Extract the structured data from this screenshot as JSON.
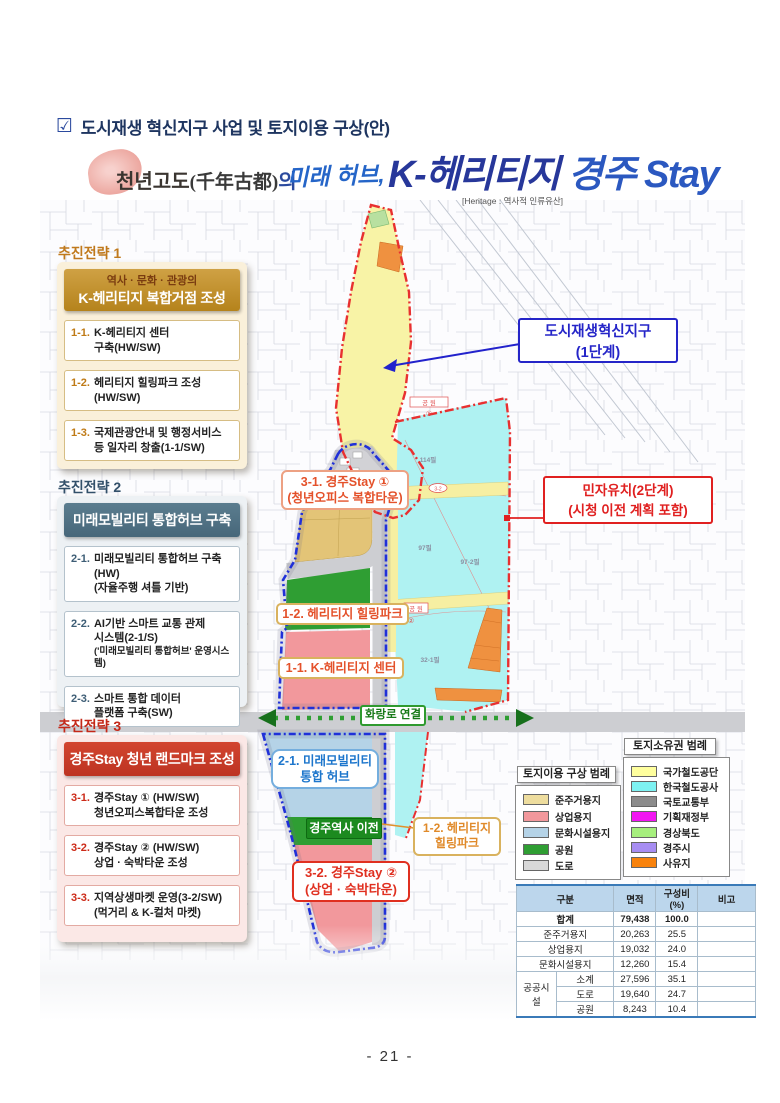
{
  "page": {
    "checkbox": "☑",
    "title": "도시재생 혁신지구 사업 및 토지이용 구상(안)",
    "page_number": "- 21 -"
  },
  "header": {
    "brand": "천년고도",
    "brand_hanja": "(千年古都)",
    "brand_josa": "의",
    "tagline": "미래 허브,",
    "logo_k": "K-헤리티지",
    "logo_stay": "경주 Stay",
    "heritage_note": "[Heritage : 역사적 인류유산]"
  },
  "strategies": [
    {
      "label": "추진전략 1",
      "header_line1": "역사 · 문화 · 관광의",
      "header_line2": "K-헤리티지 복합거점 조성",
      "items": [
        {
          "no": "1-1.",
          "lines": [
            "K-헤리티지 센터",
            "구축(HW/SW)"
          ]
        },
        {
          "no": "1-2.",
          "lines": [
            "헤리티지 힐링파크 조성(HW/SW)",
            ""
          ]
        },
        {
          "no": "1-3.",
          "lines": [
            "국제관광안내 및 행정서비스",
            "등 일자리 창출(1-1/SW)"
          ]
        }
      ]
    },
    {
      "label": "추진전략 2",
      "header_line1": "",
      "header_line2": "미래모빌리티 통합허브 구축",
      "items": [
        {
          "no": "2-1.",
          "lines": [
            "미래모빌리티 통합허브 구축(HW)",
            "(자율주행 셔틀 기반)"
          ]
        },
        {
          "no": "2-2.",
          "lines": [
            "AI기반 스마트 교통 관제",
            "시스템(2-1/S)",
            "('미래모빌리티 통합허브' 운영시스템)"
          ]
        },
        {
          "no": "2-3.",
          "lines": [
            "스마트 통합 데이터",
            "플랫폼 구축(SW)"
          ]
        }
      ]
    },
    {
      "label": "추진전략 3",
      "header_line1": "",
      "header_line2": "경주Stay 청년 랜드마크 조성",
      "items": [
        {
          "no": "3-1.",
          "lines": [
            "경주Stay ① (HW/SW)",
            "청년오피스복합타운 조성"
          ]
        },
        {
          "no": "3-2.",
          "lines": [
            "경주Stay ② (HW/SW)",
            "상업 · 숙박타운 조성"
          ]
        },
        {
          "no": "3-3.",
          "lines": [
            "지역상생마켓 운영(3-2/SW)",
            "(먹거리 & K-컬처 마켓)"
          ]
        }
      ]
    }
  ],
  "callouts": {
    "phase1": {
      "line1": "도시재생혁신지구",
      "line2": "(1단계)",
      "color": "#2525c8"
    },
    "phase2": {
      "line1": "민자유치(2단계)",
      "line2": "(시청 이전 계획 포함)",
      "color": "#e02020"
    }
  },
  "map_labels": {
    "stay1": {
      "line1": "3-1. 경주Stay ①",
      "line2": "(청년오피스 복합타운)"
    },
    "healing_park": "1-2. 헤리티지 힐링파크",
    "heritage_center": "1-1. K-헤리티지 센터",
    "hwangno_link": "화랑로 연결",
    "mobility_hub": {
      "line1": "2-1. 미래모빌리티",
      "line2": "통합 허브"
    },
    "station_move": "경주역사 이전",
    "healing_park2": {
      "line1": "1-2. 헤리티지",
      "line2": "힐링파크"
    },
    "stay2": {
      "line1": "3-2. 경주Stay ②",
      "line2": "(상업 · 숙박타운)"
    },
    "parcels": {
      "p1": "114필",
      "p2": "97필",
      "p3": "97-2필",
      "p4": "32-1필",
      "park1": "공 원",
      "park2": "공 원",
      "c1": "①",
      "c2": "②",
      "road_no": "3-2"
    }
  },
  "legend_landuse": {
    "title": "토지이용 구상 범례",
    "items": [
      {
        "label": "준주거용지",
        "color": "#eedd9e"
      },
      {
        "label": "상업용지",
        "color": "#f2989c"
      },
      {
        "label": "문화시설용지",
        "color": "#b5d3e7"
      },
      {
        "label": "공원",
        "color": "#2f9e33"
      },
      {
        "label": "도로",
        "color": "#d8d8d8"
      }
    ]
  },
  "legend_ownership": {
    "title": "토지소유권 범례",
    "items": [
      {
        "label": "국가철도공단",
        "color": "#ffff9e"
      },
      {
        "label": "한국철도공사",
        "color": "#7df2f2"
      },
      {
        "label": "국토교통부",
        "color": "#8c8c8c"
      },
      {
        "label": "기획재정부",
        "color": "#f216f2"
      },
      {
        "label": "경상북도",
        "color": "#a6ef7d"
      },
      {
        "label": "경주시",
        "color": "#a78df2"
      },
      {
        "label": "사유지",
        "color": "#f8820c"
      }
    ]
  },
  "table": {
    "col_group": "구분",
    "col_area": "면적",
    "col_ratio": "구성비(%)",
    "col_note": "비고",
    "total": {
      "name": "합계",
      "area": "79,438",
      "ratio": "100.0"
    },
    "rows": [
      {
        "name": "준주거용지",
        "area": "20,263",
        "ratio": "25.5"
      },
      {
        "name": "상업용지",
        "area": "19,032",
        "ratio": "24.0"
      },
      {
        "name": "문화시설용지",
        "area": "12,260",
        "ratio": "15.4"
      }
    ],
    "public_group": "공공시설",
    "public_rows": [
      {
        "name": "소계",
        "area": "27,596",
        "ratio": "35.1"
      },
      {
        "name": "도로",
        "area": "19,640",
        "ratio": "24.7"
      },
      {
        "name": "공원",
        "area": "8,243",
        "ratio": "10.4"
      }
    ]
  }
}
